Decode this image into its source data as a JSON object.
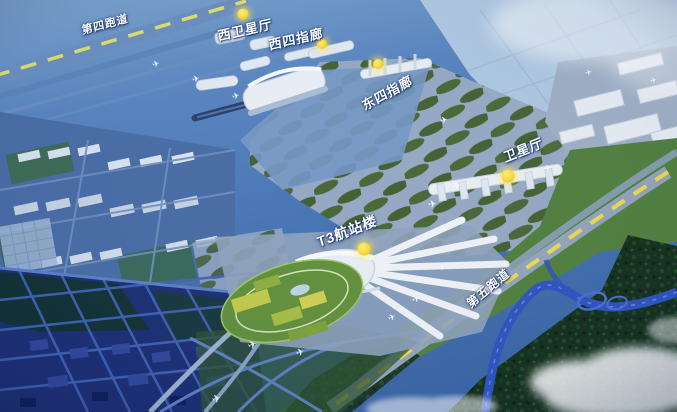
{
  "image_type": "airport-masterplan-aerial-rendering",
  "annotations": [
    {
      "id": "runway-4",
      "label": "第四跑道",
      "has_marker": false
    },
    {
      "id": "west-satellite-hall",
      "label": "西卫星厅",
      "has_marker": true
    },
    {
      "id": "west-pier-4",
      "label": "西四指廊",
      "has_marker": true
    },
    {
      "id": "east-pier-4",
      "label": "东四指廊",
      "has_marker": true
    },
    {
      "id": "satellite-hall",
      "label": "卫星厅",
      "has_marker": true
    },
    {
      "id": "t3-terminal",
      "label": "T3航站楼",
      "has_marker": true
    },
    {
      "id": "runway-5",
      "label": "第五跑道",
      "has_marker": false
    }
  ],
  "colors": {
    "base_blue": "#4a76b4",
    "runway_dash_yellow": "#e9dc55",
    "marker_yellow": "#f2d238",
    "label_white": "#ffffff",
    "terminal_white": "#e9eef5",
    "taxiway_gray": "#97aac4",
    "infield_green": "#4a6733",
    "park_green": "#62903c",
    "forest_green": "#16311e",
    "city_navy": "#1d2f74",
    "river_blue": "#2e55c0",
    "haze_light": "#bdd2e6"
  }
}
